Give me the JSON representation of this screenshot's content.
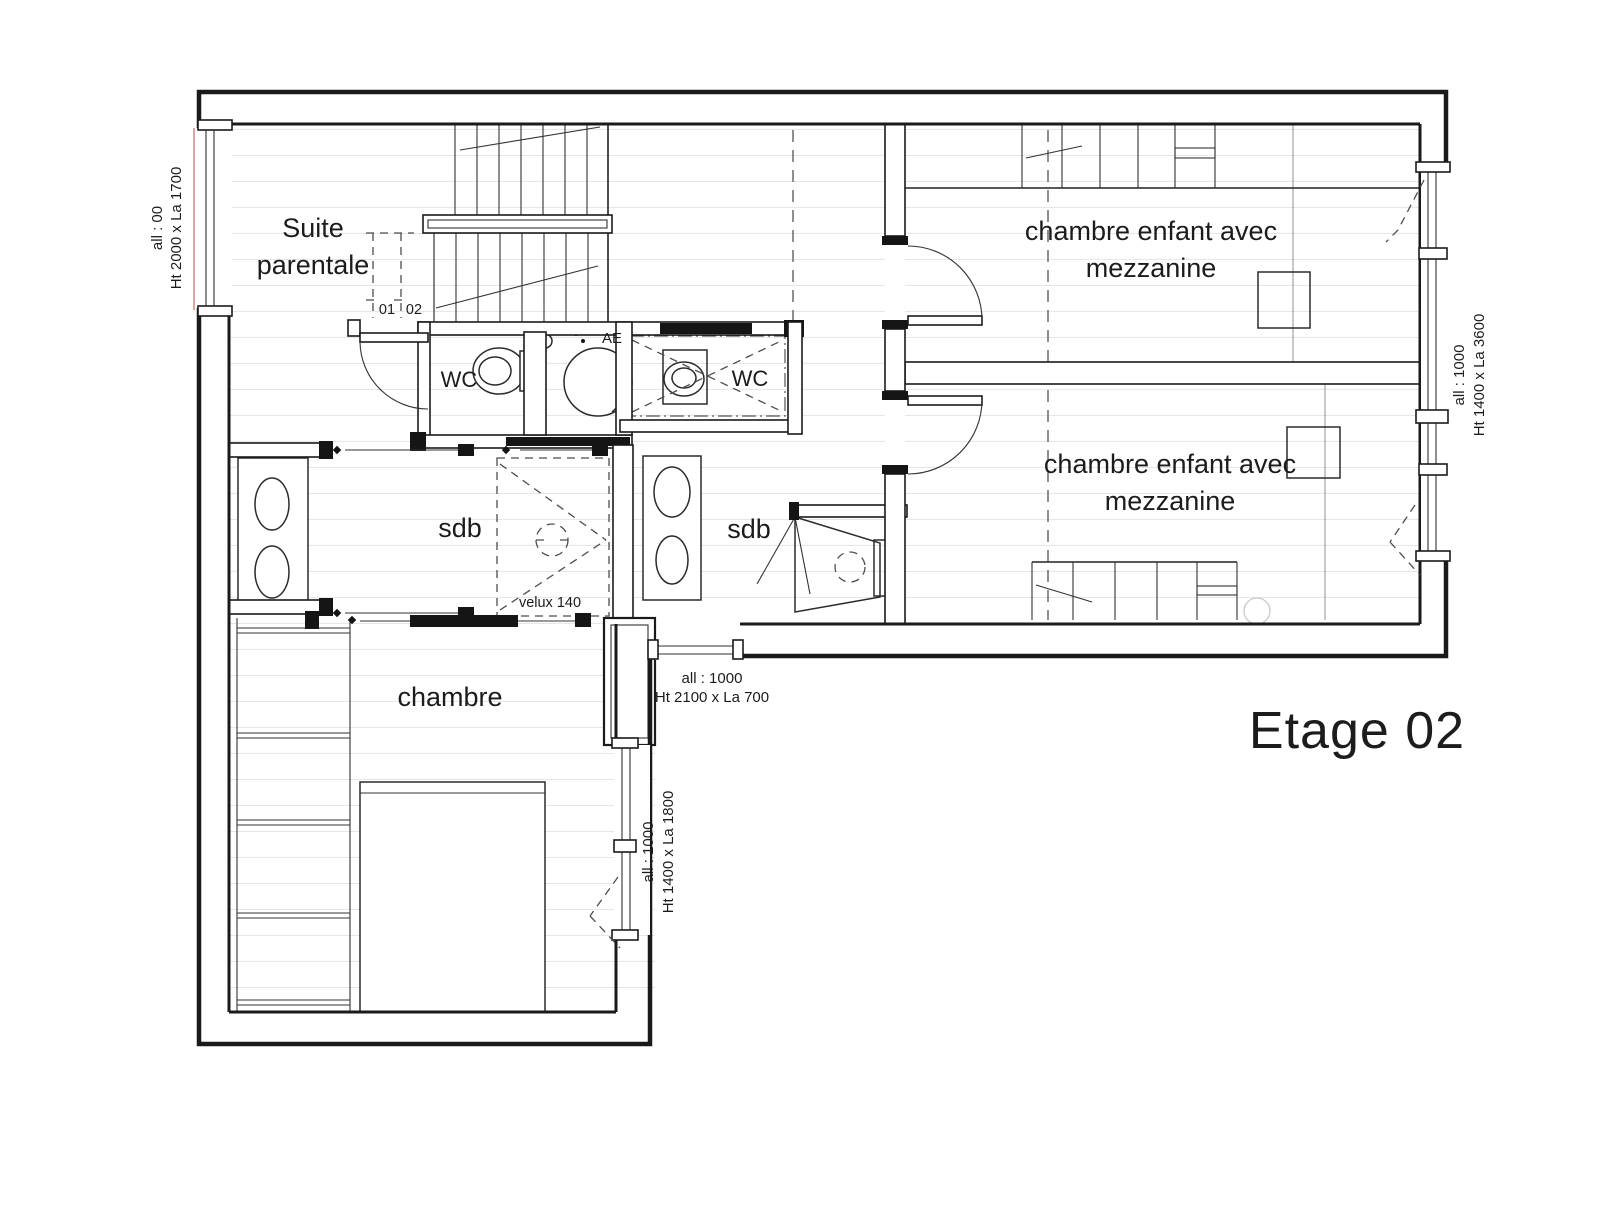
{
  "title": "Etage 02",
  "colors": {
    "wall": "#1a1a1a",
    "floor_line": "#e7e7e7",
    "dash": "#6a6a6a",
    "window_accent_red": "#b5483c",
    "light_grey": "#c9c9c9"
  },
  "rooms": {
    "suite_parentale": {
      "line1": "Suite",
      "line2": "parentale"
    },
    "wc_left": {
      "label": "WC"
    },
    "wc_right": {
      "label": "WC"
    },
    "sdb_left": {
      "label": "sdb"
    },
    "sdb_right": {
      "label": "sdb"
    },
    "chambre": {
      "label": "chambre"
    },
    "chambre_enfant_haut": {
      "line1": "chambre enfant avec",
      "line2": "mezzanine"
    },
    "chambre_enfant_bas": {
      "line1": "chambre enfant avec",
      "line2": "mezzanine"
    }
  },
  "annotations": {
    "velux": "velux 140",
    "ae": "AE",
    "duct_left": "01",
    "duct_right": "02"
  },
  "windows": {
    "left": {
      "line1": "all : 00",
      "line2": "Ht 2000 x La 1700"
    },
    "right": {
      "line1": "all : 1000",
      "line2": "Ht 1400 x La 3600"
    },
    "corridor": {
      "line1": "all : 1000",
      "line2": "Ht 2100 x La 700"
    },
    "chambre": {
      "line1": "all : 1000",
      "line2": "Ht 1400 x La 1800"
    }
  }
}
